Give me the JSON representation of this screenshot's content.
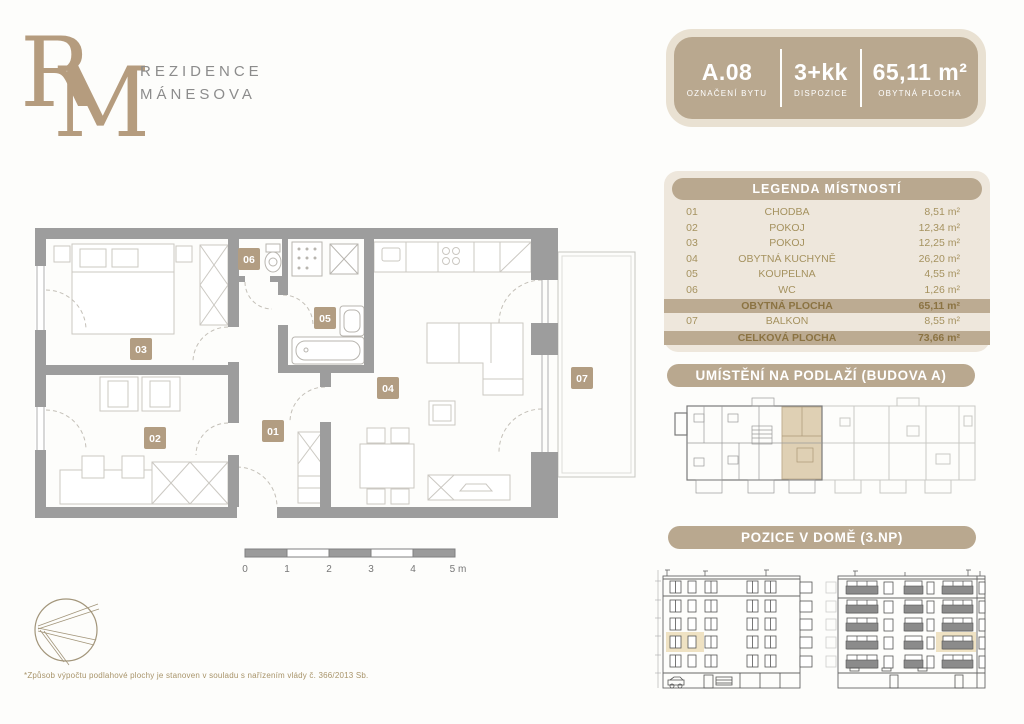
{
  "brand": {
    "monogram_r": "R",
    "monogram_m": "M",
    "name_line1": "REZIDENCE",
    "name_line2": "MÁNESOVA"
  },
  "unit_card": {
    "id_value": "A.08",
    "id_label": "OZNAČENÍ BYTU",
    "layout_value": "3+kk",
    "layout_label": "DISPOZICE",
    "area_value": "65,11 m²",
    "area_label": "OBYTNÁ PLOCHA"
  },
  "legend": {
    "title": "LEGENDA MÍSTNOSTÍ",
    "rows": [
      {
        "num": "01",
        "name": "CHODBA",
        "area": "8,51 m²",
        "type": "room"
      },
      {
        "num": "02",
        "name": "POKOJ",
        "area": "12,34 m²",
        "type": "room"
      },
      {
        "num": "03",
        "name": "POKOJ",
        "area": "12,25 m²",
        "type": "room"
      },
      {
        "num": "04",
        "name": "OBYTNÁ KUCHYNĚ",
        "area": "26,20 m²",
        "type": "room"
      },
      {
        "num": "05",
        "name": "KOUPELNA",
        "area": "4,55 m²",
        "type": "room"
      },
      {
        "num": "06",
        "name": "WC",
        "area": "1,26 m²",
        "type": "room"
      },
      {
        "num": "",
        "name": "OBYTNÁ PLOCHA",
        "area": "65,11 m²",
        "type": "summary"
      },
      {
        "num": "07",
        "name": "BALKON",
        "area": "8,55 m²",
        "type": "room"
      },
      {
        "num": "",
        "name": "CELKOVÁ PLOCHA",
        "area": "73,66 m²",
        "type": "summary"
      }
    ]
  },
  "sections": {
    "floor_location": "UMÍSTĚNÍ NA PODLAŽÍ (BUDOVA A)",
    "house_position": "POZICE V DOMĚ (3.NP)"
  },
  "plan": {
    "room_labels": [
      "01",
      "02",
      "03",
      "04",
      "05",
      "06",
      "07"
    ]
  },
  "scale_bar": {
    "ticks": [
      "0",
      "1",
      "2",
      "3",
      "4",
      "5 m"
    ]
  },
  "footnote": "*Způsob výpočtu podlahové plochy je stanoven v souladu s nařízením vlády č. 366/2013 Sb.",
  "colors": {
    "tan": "#b9a88f",
    "panel_cream": "#eee7dc",
    "gold_text": "#a5925f",
    "wall_gray": "#9d9d9d",
    "highlight": "#d8c5a3"
  }
}
